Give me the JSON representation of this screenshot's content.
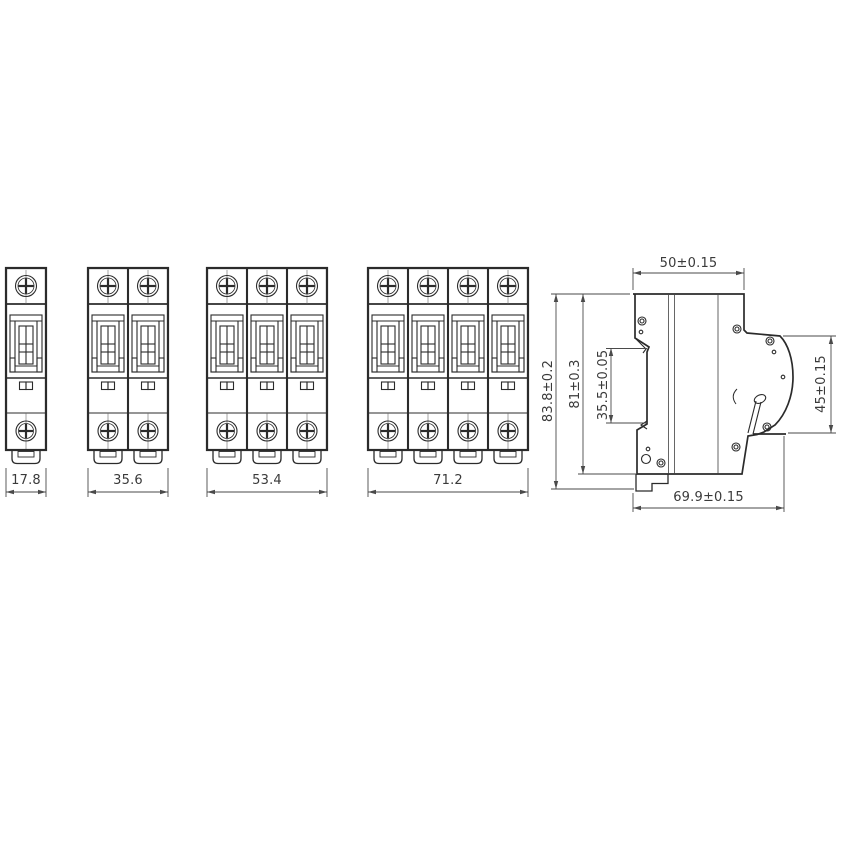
{
  "drawing": {
    "background": "#ffffff",
    "line_color": "#2b2b2b",
    "dimension_color": "#4a4a4a",
    "front_views": [
      {
        "name": "breaker-1-pole",
        "poles": 1,
        "width_label": "17.8"
      },
      {
        "name": "breaker-2-pole",
        "poles": 2,
        "width_label": "35.6"
      },
      {
        "name": "breaker-3-pole",
        "poles": 3,
        "width_label": "53.4"
      },
      {
        "name": "breaker-4-pole",
        "poles": 4,
        "width_label": "71.2"
      }
    ],
    "side_view": {
      "name": "breaker-side-profile",
      "labels": {
        "top_width": "50±0.15",
        "overall_height": "83.8±0.2",
        "body_height": "81±0.3",
        "din_slot_height": "35.5±0.05",
        "front_face_height": "45±0.15",
        "overall_depth": "69.9±0.15"
      }
    }
  }
}
